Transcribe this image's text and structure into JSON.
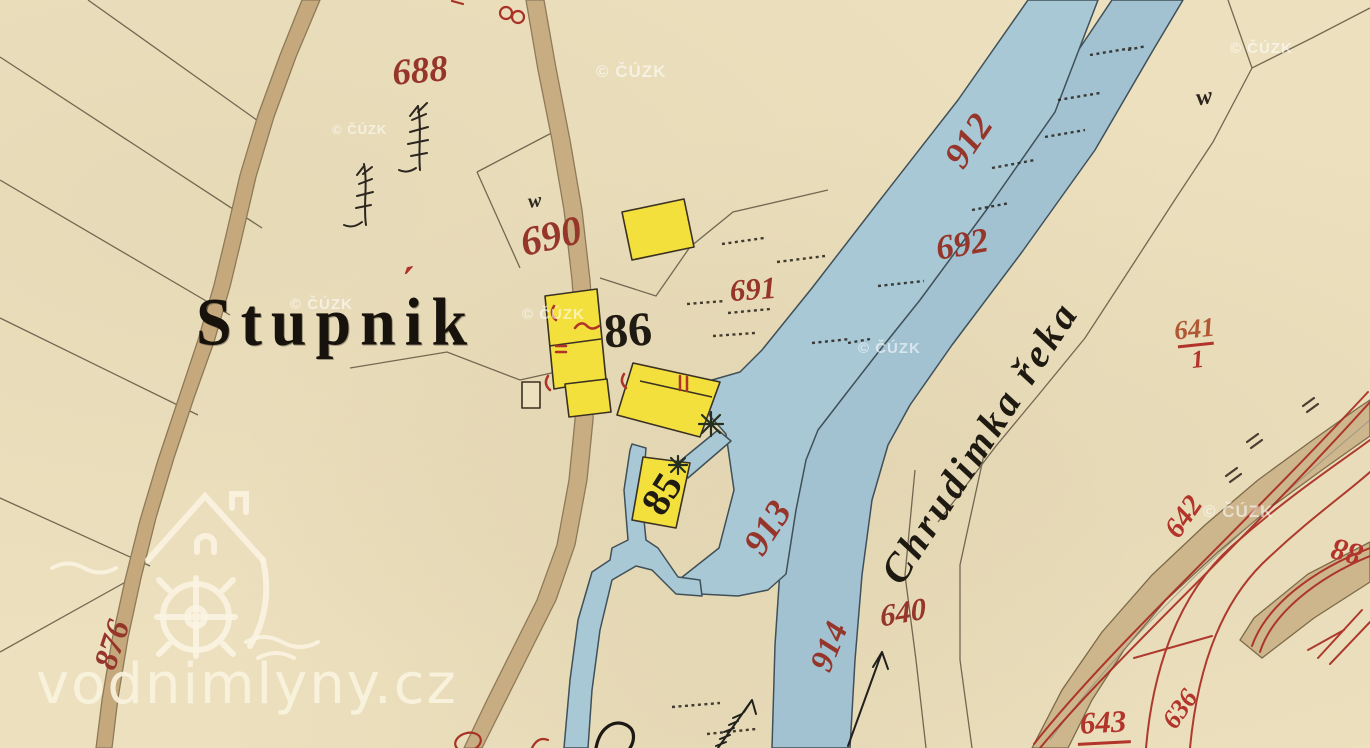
{
  "watermarks": {
    "cuzk": "© ČÚZK",
    "site": "vodnimlyny.cz"
  },
  "place": {
    "name": "Stupník",
    "name_base": "Stupnik",
    "accent_mark": "´"
  },
  "river": {
    "label": "Chrudimka řeka"
  },
  "house_numbers": {
    "h86": "86",
    "h85": "85"
  },
  "parcel_numbers": {
    "p688": "688",
    "p690": "690",
    "p691": "691",
    "p692": "692",
    "p912": "912",
    "p913": "913",
    "p914": "914",
    "p640": "640",
    "p876": "876",
    "p642": "642",
    "p643": "643",
    "p636": "636",
    "p88": "88"
  },
  "fraction_641": {
    "numerator": "641",
    "denominator": "1"
  },
  "symbols": {
    "grass": "w"
  },
  "colors": {
    "paper": "#ece0be",
    "water": "#a9c8d6",
    "water_outline": "#3f5058",
    "road": "#c9ad82",
    "building": "#f3e03c",
    "ink_red": "#96352a",
    "pencil_red": "#b2342a",
    "ink_black": "#201b12",
    "watermark_cream": "#f6eed8"
  }
}
